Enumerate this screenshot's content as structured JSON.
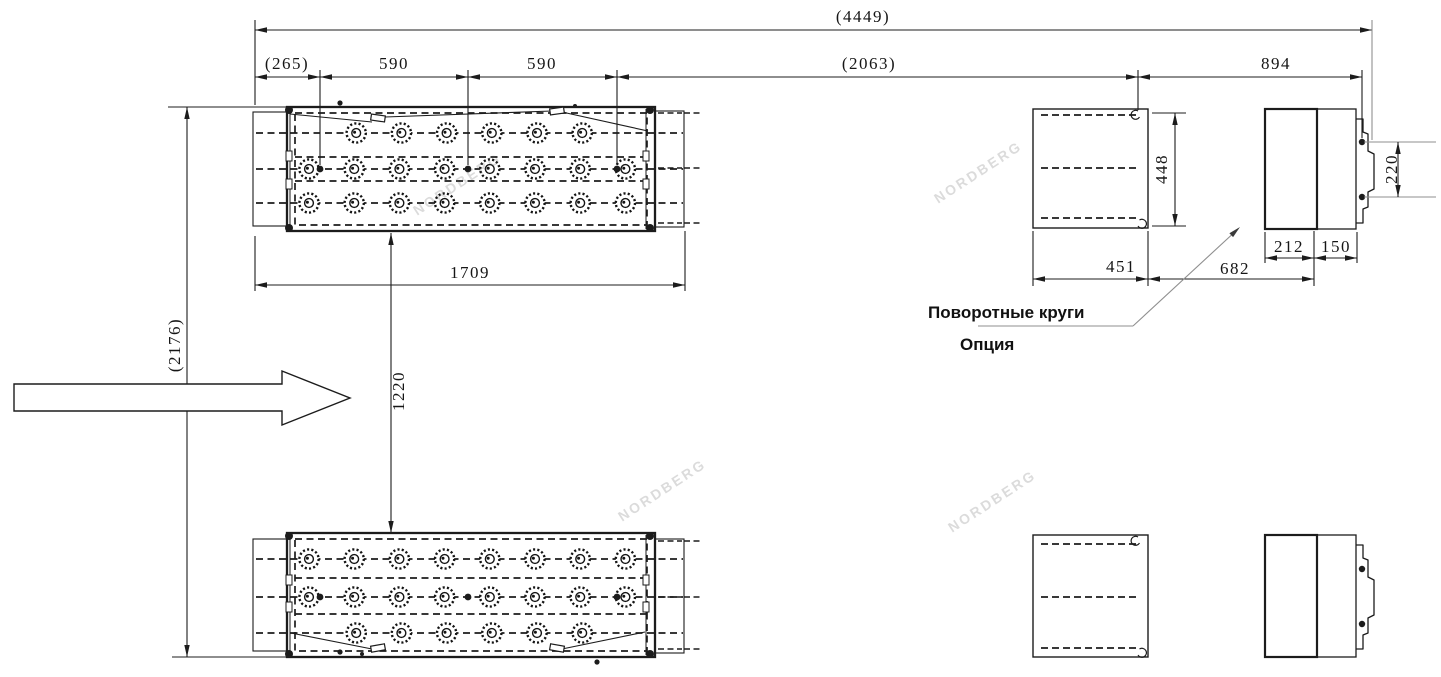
{
  "watermark": {
    "text": "NORDBERG"
  },
  "labels": {
    "turntables": "Поворотные круги",
    "option": "Опция"
  },
  "dims": {
    "total_length": "(4449)",
    "left_offset": "(265)",
    "pitch_a": "590",
    "pitch_b": "590",
    "mid_span": "(2063)",
    "right_span": "894",
    "platform_length": "1709",
    "overall_width": "(2176)",
    "track_gap": "1220",
    "side_height": "448",
    "side_length": "451",
    "turntable_offset": "682",
    "turntable_width": "212",
    "turntable_tab": "150",
    "bracket_pitch": "220"
  }
}
